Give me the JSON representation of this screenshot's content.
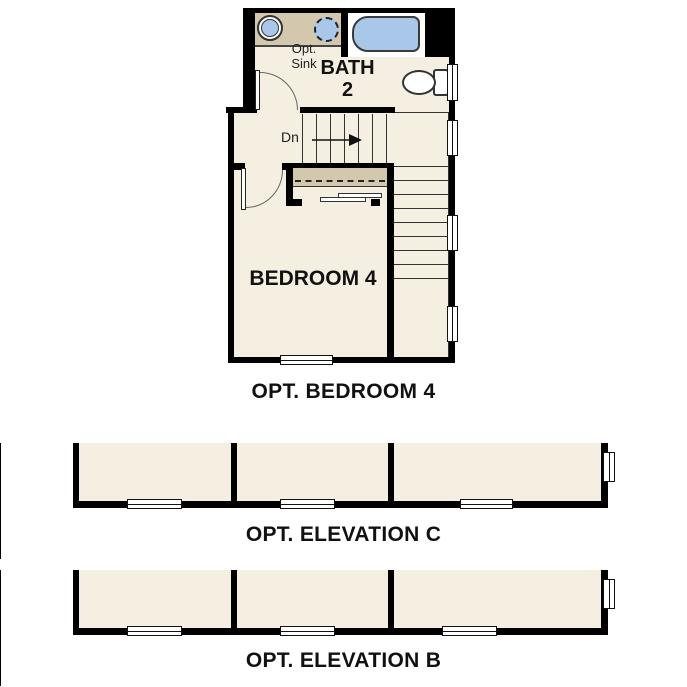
{
  "colors": {
    "wall": "#000000",
    "room_fill": "#f5efe2",
    "counter_fill": "#d3c7ae",
    "fixture_blue": "#a9c8e9",
    "line": "#333333"
  },
  "floor_plan": {
    "caption": "OPT. BEDROOM 4",
    "bath": {
      "line1": "BATH",
      "line2": "2"
    },
    "bedroom": {
      "label": "BEDROOM 4"
    },
    "opt_sink": {
      "line1": "Opt.",
      "line2": "Sink"
    },
    "stairs": {
      "down_label": "Dn"
    },
    "fixtures": [
      "vanity-sink",
      "optional-sink",
      "bathtub",
      "toilet"
    ]
  },
  "elevations": [
    {
      "id": "C",
      "caption": "OPT. ELEVATION C"
    },
    {
      "id": "B",
      "caption": "OPT. ELEVATION B"
    }
  ]
}
